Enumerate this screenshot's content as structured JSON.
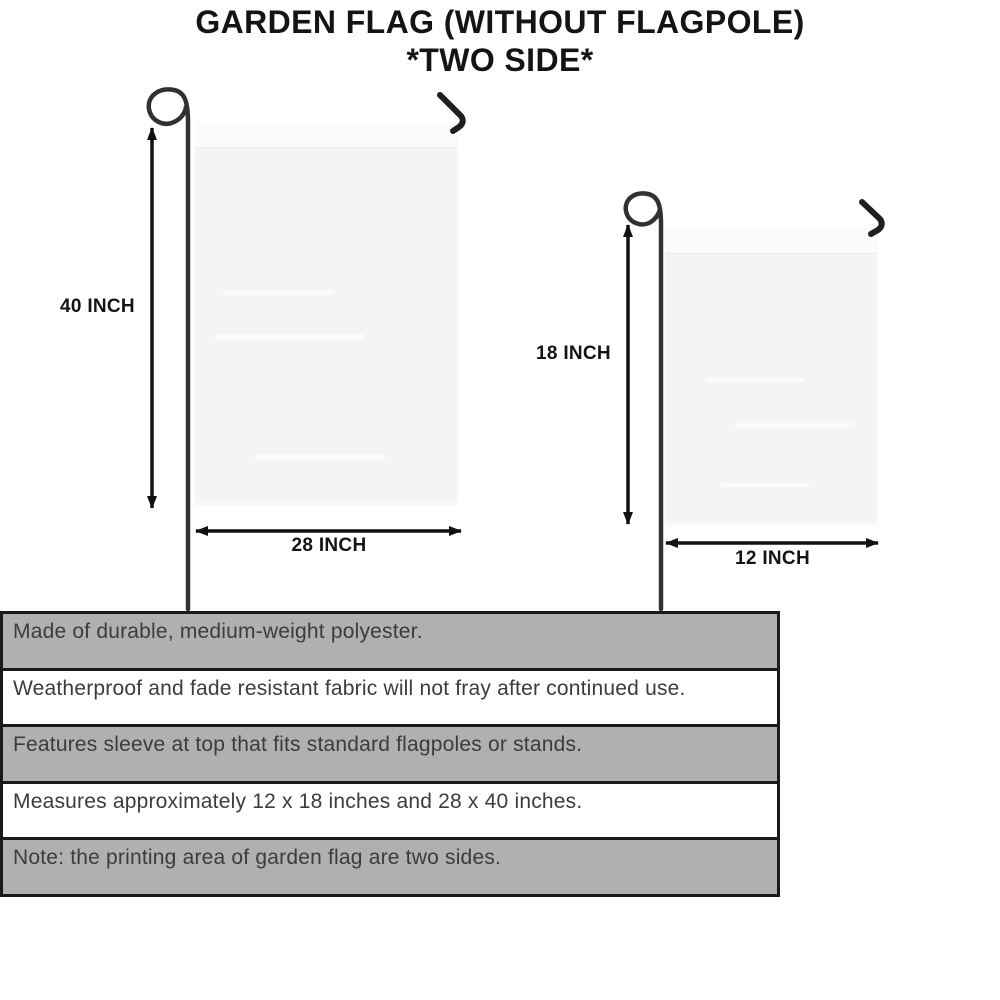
{
  "title": {
    "line1": "GARDEN FLAG (WITHOUT FLAGPOLE)",
    "line2": "*TWO SIDE*"
  },
  "diagram": {
    "large_flag": {
      "name": "large garden flag 28 x 40",
      "height_label": "40 INCH",
      "width_label": "28 INCH"
    },
    "small_flag": {
      "name": "small garden flag 12 x 18",
      "height_label": "18 INCH",
      "width_label": "12 INCH"
    }
  },
  "features": {
    "rows": [
      {
        "text": "Made of durable, medium-weight polyester.",
        "shaded": true
      },
      {
        "text": "Weatherproof and fade resistant fabric will not fray after continued use.",
        "shaded": false
      },
      {
        "text": "Features sleeve at top that fits standard flagpoles or stands.",
        "shaded": true
      },
      {
        "text": "Measures approximately 12 x 18 inches and 28 x 40 inches.",
        "shaded": false
      },
      {
        "text": "Note: the printing area of garden flag are two sides.",
        "shaded": true
      }
    ]
  },
  "colors": {
    "table_gray": "#b0b0b0",
    "table_border": "#1a1a1a",
    "body_text": "#3c3c3c",
    "flag_fill": "#f5f4f2",
    "metal_dark": "#33312e",
    "arrow_black": "#111111"
  }
}
